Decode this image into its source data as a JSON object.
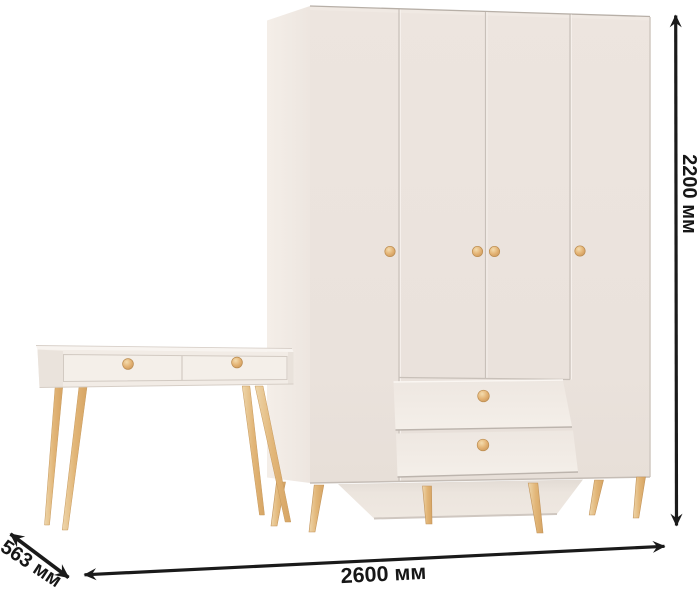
{
  "image": {
    "type": "furniture-product-with-dimensions",
    "background": "#ffffff"
  },
  "dimensions": {
    "height": {
      "label": "2200 мм"
    },
    "width": {
      "label": "2600 мм"
    },
    "depth": {
      "label": "563 мм"
    }
  },
  "colors": {
    "arrow": "#1a1a1a",
    "label": "#161616",
    "cabinet_front": "#ece4de",
    "cabinet_side": "#f2ece6",
    "edge_line": "#c8c0b9",
    "wood": "#deb071"
  },
  "furniture": {
    "wardrobe": {
      "name": "four-door-wardrobe",
      "doors": 4,
      "drawers": 2,
      "knobs": 6
    },
    "console_table": {
      "name": "console-table",
      "drawers": 2,
      "knobs": 2
    }
  }
}
